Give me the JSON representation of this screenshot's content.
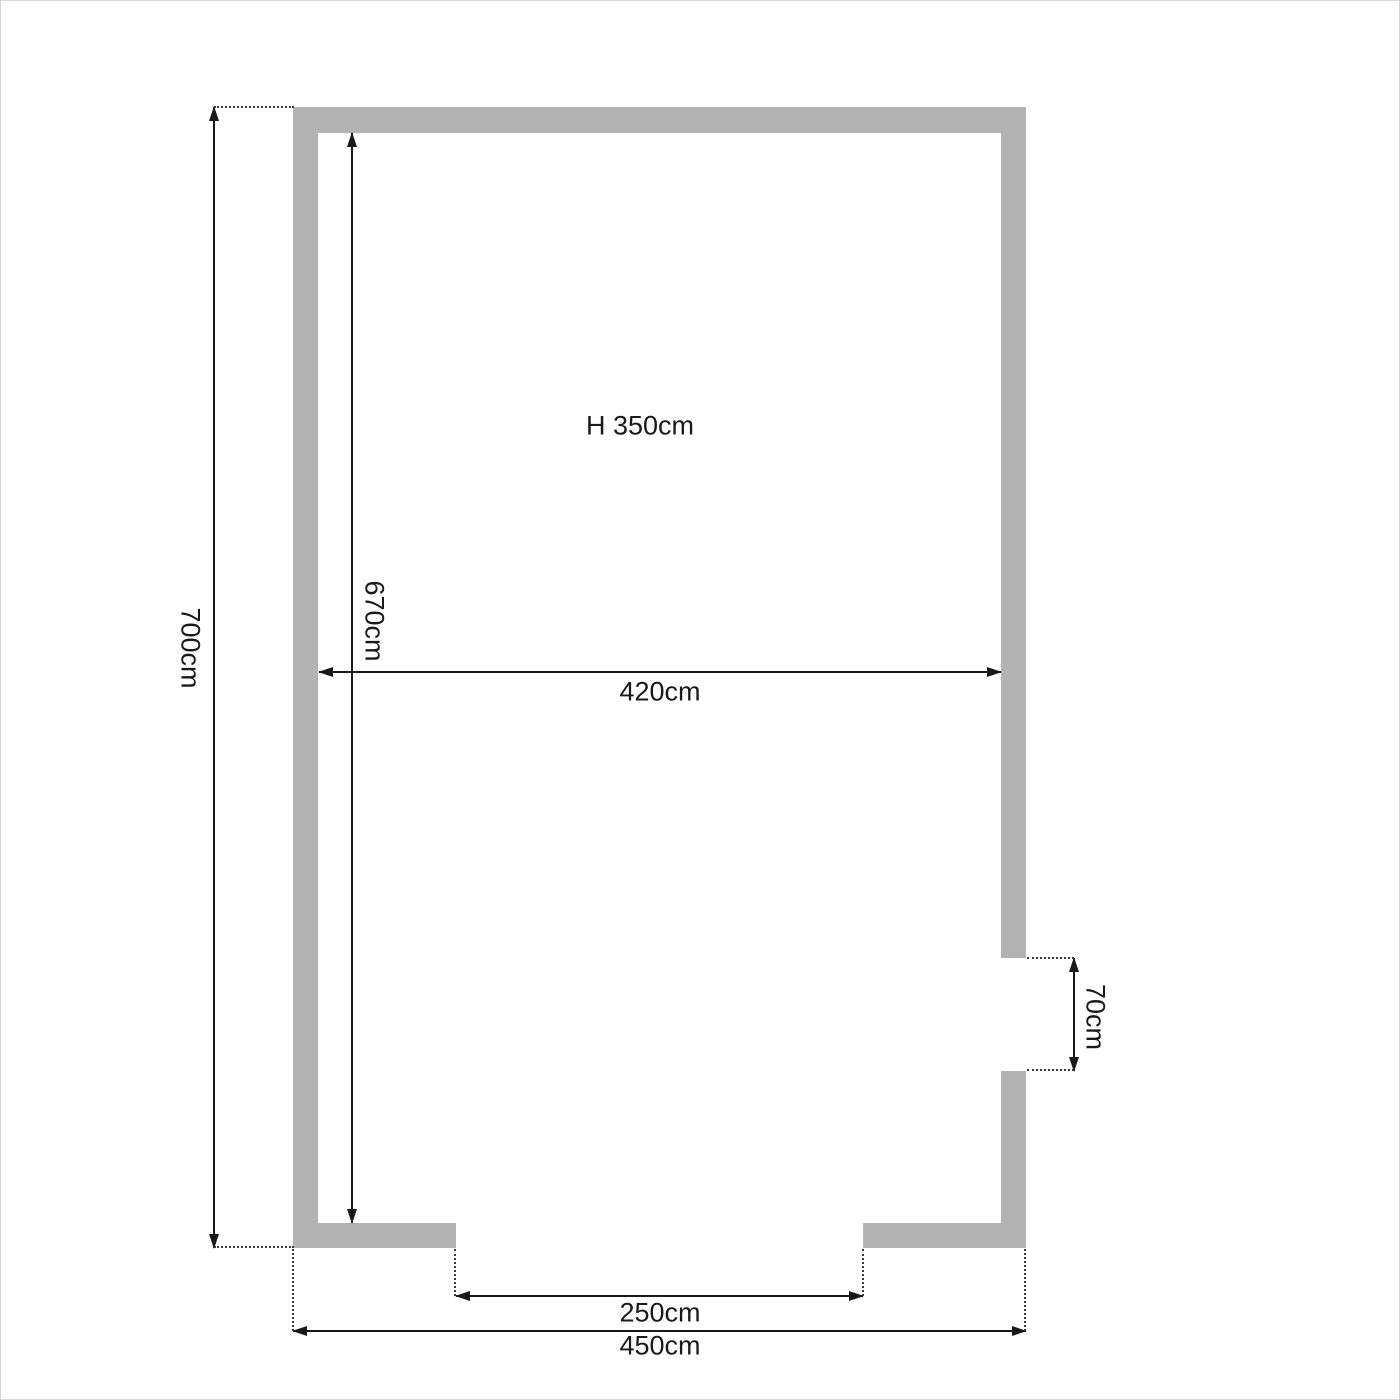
{
  "diagram": {
    "type": "floor-plan",
    "unit": "cm",
    "labels": {
      "ceiling_height": "H 350cm",
      "outer_height": "700cm",
      "inner_height": "670cm",
      "inner_width": "420cm",
      "right_opening": "70cm",
      "bottom_opening": "250cm",
      "outer_width": "450cm"
    },
    "values": {
      "ceiling_height_cm": 350,
      "outer_height_cm": 700,
      "inner_height_cm": 670,
      "inner_width_cm": 420,
      "right_opening_cm": 70,
      "bottom_opening_cm": 250,
      "outer_width_cm": 450
    },
    "colors": {
      "wall_fill": "#b3b3b3",
      "dimension_line": "#1a1a1a",
      "extension_dots": "#3a3a3a",
      "background": "#ffffff",
      "page_border": "#d8d8d8"
    }
  }
}
